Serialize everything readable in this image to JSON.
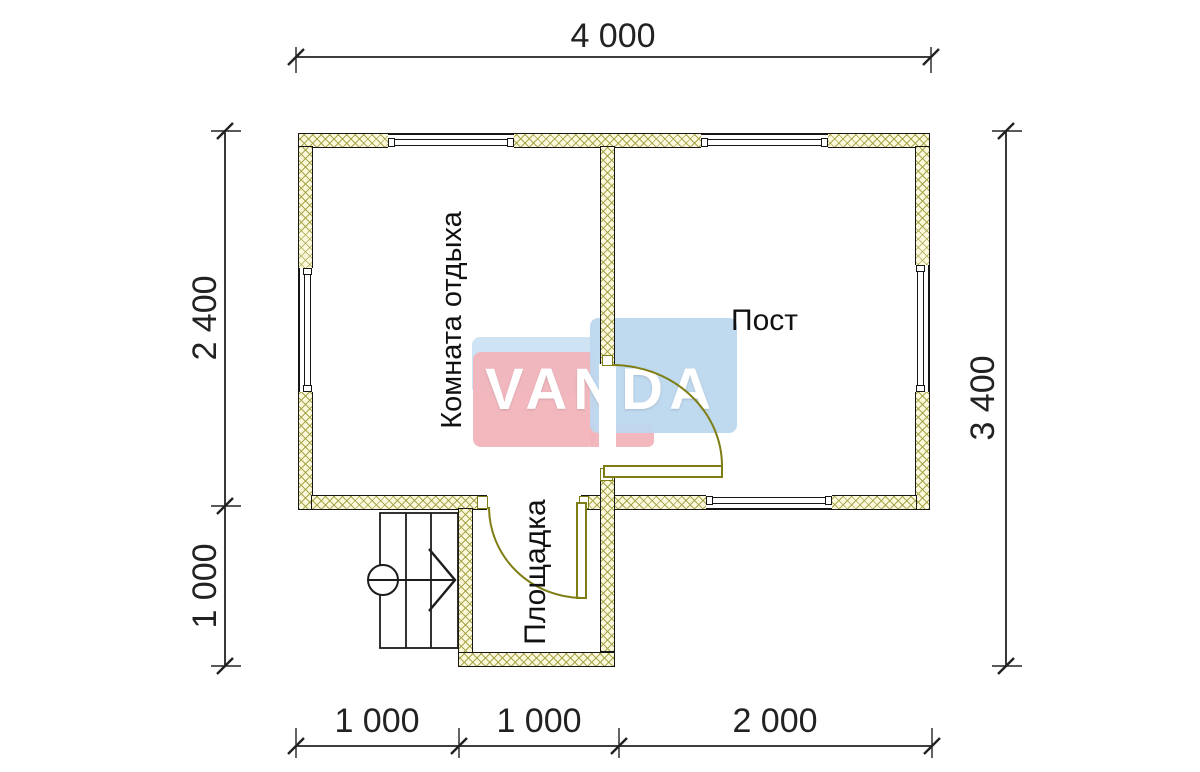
{
  "plan": {
    "title": "bath-house floor plan",
    "rooms": [
      {
        "name": "Комната отдыха"
      },
      {
        "name": "Пост"
      },
      {
        "name": "Площадка"
      }
    ],
    "dimensions": {
      "top": "4 000",
      "left_upper": "2 400",
      "left_lower": "1 000",
      "right": "3 400",
      "bottom_left": "1 000",
      "bottom_middle": "1 000",
      "bottom_right": "2 000"
    },
    "watermark": "VANDA",
    "colors": {
      "wall_fill": "#fbf8dc",
      "hatch_line": "#9e9e3e",
      "door": "#7e7e14",
      "line": "#161616",
      "dimension_text": "#222222",
      "watermark_pink": "#f2b4bb",
      "watermark_blue": "#bcd7ee"
    }
  }
}
